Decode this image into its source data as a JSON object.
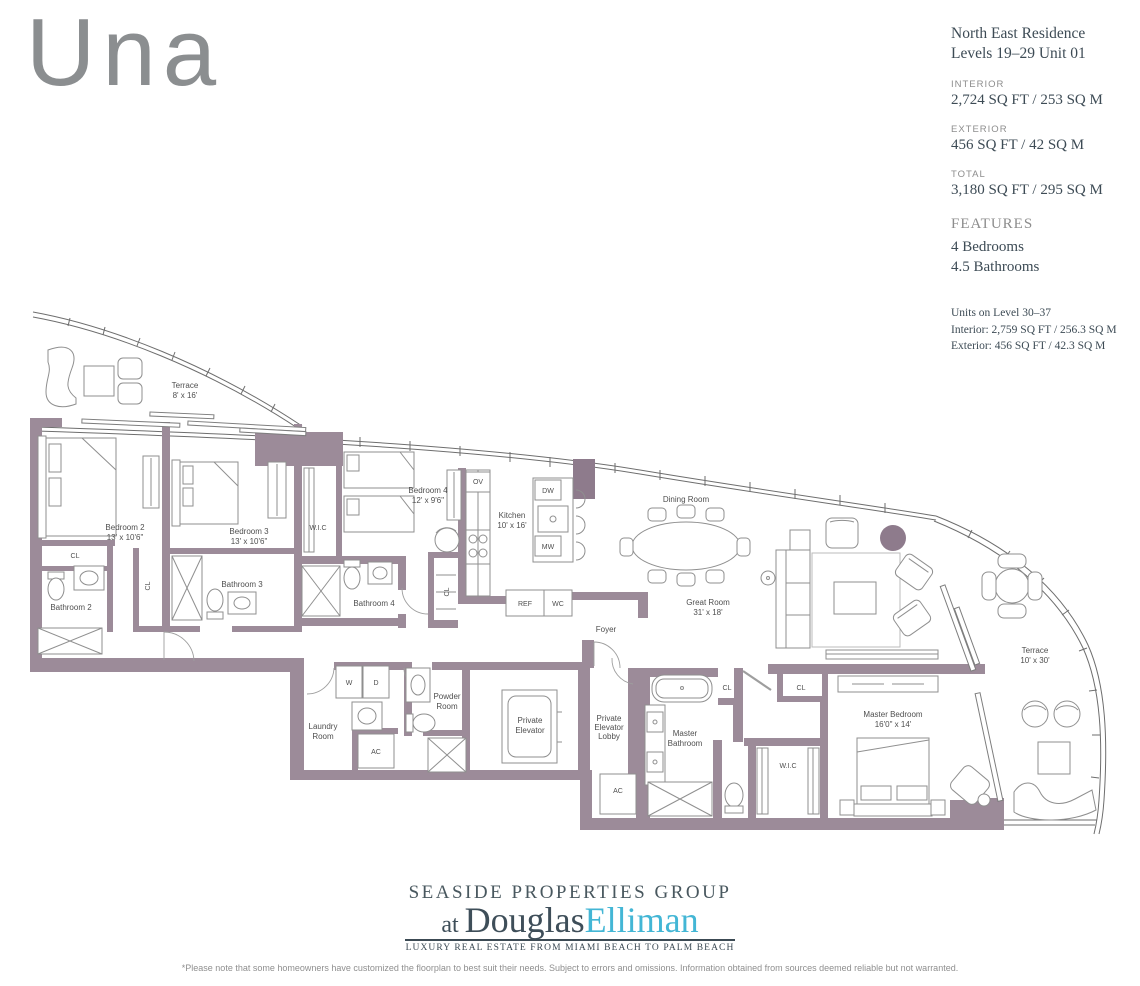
{
  "logo": {
    "text": "Una",
    "color": "#8b8e90"
  },
  "info_panel": {
    "title_line1": "North East Residence",
    "title_line2": "Levels 19–29 Unit 01",
    "sections": [
      {
        "label": "INTERIOR",
        "value": "2,724 SQ FT / 253 SQ M"
      },
      {
        "label": "EXTERIOR",
        "value": "456 SQ FT / 42 SQ M"
      },
      {
        "label": "TOTAL",
        "value": "3,180 SQ FT / 295 SQ M"
      }
    ],
    "features_label": "FEATURES",
    "features": [
      "4 Bedrooms",
      "4.5 Bathrooms"
    ],
    "upper_levels_note": [
      "Units on Level 30–37",
      "Interior: 2,759 SQ FT / 256.3 SQ M",
      "Exterior: 456 SQ FT / 42.3 SQ M"
    ]
  },
  "floorplan": {
    "wall_color": "#9c8b99",
    "line_color": "#6e6e6e",
    "labels": {
      "terrace_l_name": "Terrace",
      "terrace_l_dim": "8' x 16'",
      "bedroom2_name": "Bedroom 2",
      "bedroom2_dim": "13' x 10'6\"",
      "bedroom3_name": "Bedroom 3",
      "bedroom3_dim": "13' x 10'6\"",
      "bathroom2": "Bathroom 2",
      "bathroom3": "Bathroom 3",
      "bathroom4": "Bathroom 4",
      "cl1": "CL",
      "cl2": "CL",
      "cl3": "CL",
      "cl4": "CL",
      "cl5": "CL",
      "wic1": "W.I.C",
      "wic2": "W.I.C",
      "bedroom4_name": "Bedroom 4",
      "bedroom4_dim": "12' x 9'6\"",
      "kitchen_name": "Kitchen",
      "kitchen_dim": "10' x 16'",
      "ov": "OV",
      "dw": "DW",
      "mw": "MW",
      "ref": "REF",
      "wc": "WC",
      "dining": "Dining Room",
      "great_name": "Great Room",
      "great_dim": "31' x 18'",
      "foyer": "Foyer",
      "laundry1": "Laundry",
      "laundry2": "Room",
      "w": "W",
      "d": "D",
      "ac1": "AC",
      "ac2": "AC",
      "powder1": "Powder",
      "powder2": "Room",
      "pelev1": "Private",
      "pelev2": "Elevator",
      "plobby1": "Private",
      "plobby2": "Elevator",
      "plobby3": "Lobby",
      "mbath1": "Master",
      "mbath2": "Bathroom",
      "mbed_name": "Master Bedroom",
      "mbed_dim": "16'0\" x 14'",
      "terrace_r_name": "Terrace",
      "terrace_r_dim": "10' x 30'"
    }
  },
  "brand": {
    "line1": "SEASIDE PROPERTIES GROUP",
    "at": "at ",
    "name1": "Douglas",
    "name2": "Elliman",
    "tagline": "LUXURY REAL ESTATE FROM MIAMI BEACH TO PALM BEACH",
    "accent_color": "#43b6d5"
  },
  "disclaimer": "*Please note that some homeowners have customized the floorplan to best suit their needs. Subject to errors and omissions. Information obtained from sources deemed reliable but not warranted."
}
